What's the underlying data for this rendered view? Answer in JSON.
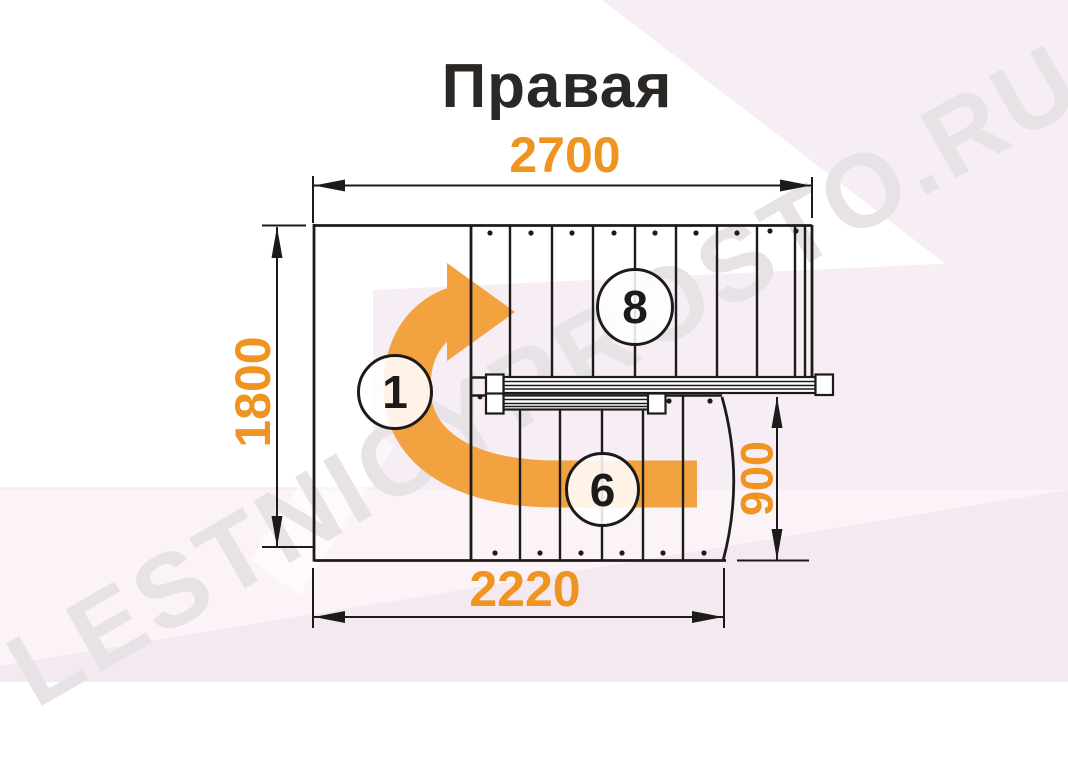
{
  "title": "Правая",
  "watermark": "LESTNICYPROSTO.RU",
  "dimensions": {
    "top_width_mm": "2700",
    "left_height_mm": "1800",
    "right_flight_width_mm": "900",
    "bottom_width_mm": "2220"
  },
  "step_labels": {
    "start_step": "1",
    "upper_flight_steps": "8",
    "lower_flight_steps": "6"
  },
  "colors": {
    "accent_orange": "#F09421",
    "arrow_orange": "#F2A23E",
    "line_black": "#1D1B1A",
    "title_ink": "#2A2725",
    "watermark_gray": "#E7E2E6",
    "pink_light": "#F7EDF4",
    "pink_lighter": "#FBF3F8",
    "pink_dark": "#F4E9F0"
  }
}
